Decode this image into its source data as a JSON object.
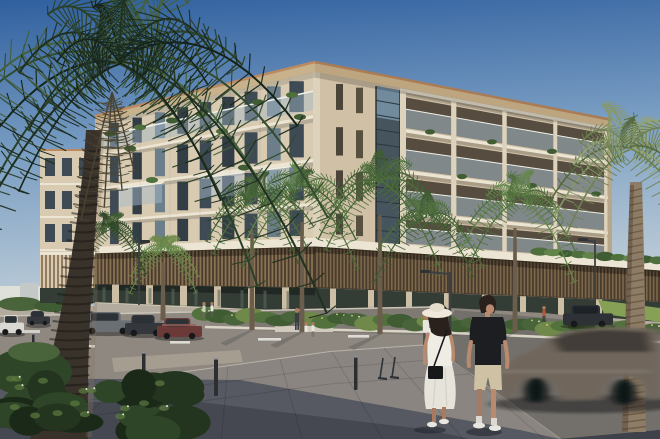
{
  "scene": {
    "type": "architectural-rendering",
    "description": "Sunny street-level view of a modern five-storey beige apartment building with wrap-around balconies, a timber-louvre podium and glazed ground floor, fronted by rows of palm trees; a couple crosses a paved plaza in the foreground while a motion-blurred car passes on the right.",
    "objects": [
      "sky",
      "apartment-building",
      "roof-cornice",
      "balconies",
      "louvre-podium",
      "storefront-glazing",
      "street-palm-trees",
      "left-palm-tree",
      "right-palm-tree",
      "road",
      "lane-markings",
      "far-sidewalk",
      "landscaping-strip",
      "foreground-plaza",
      "parked-cars",
      "moving-car",
      "pedestrian-couple",
      "background-pedestrians",
      "street-lamps",
      "bollards",
      "scooters",
      "foreground-shrubs",
      "distant-buildings"
    ]
  },
  "colors": {
    "sky_top": "#30609f",
    "sky_mid": "#7a9ec3",
    "sky_horizon": "#cdd7dc",
    "facade_front": "#d8cbb2",
    "facade_side": "#cfc0a6",
    "facade_top": "#e3d9c5",
    "facade_pier": "#ddd2bb",
    "fascia": "#ece5d3",
    "end_wall": "#b6a68a",
    "soffit_front": "#c8b28c",
    "soffit_side": "#bda57f",
    "copper": "#bc8a60",
    "copper_dark": "#a97c55",
    "window": "#3e4a54",
    "window_deep": "#333d46",
    "window_light": "#6c7e8a",
    "recess": "#564c40",
    "rail_glass": "#a5bac7",
    "rail_white": "#eef0ea",
    "corner_glass": "#46545e",
    "glass_sky": "#7c97ab",
    "mullion": "#2c363e",
    "slit": "#4a4439",
    "louver_dark": "#4a3c2c",
    "louver_fin": "#8a7254",
    "louver_fin2": "#7d684c",
    "storefront": "#333d36",
    "store_reflect": "#5a685c",
    "store_pier": "#cdbfa5",
    "sidewalk": "#b3ac9e",
    "road": "#8e8881",
    "marking": "#e8e6e0",
    "curb": "#cac4b8",
    "curb_near": "#b9b4aa",
    "plaza": "#8a8580",
    "plaza_mid": "#565961",
    "plaza_dark": "#454851",
    "plaza_corner": "#3f424a",
    "tactile": "#a59e90",
    "planting_dark": "#3f5c33",
    "planting": "#52713d",
    "planting_light": "#70894a",
    "hedge": "#49633a",
    "grass": "#86a055",
    "flower_y": "#c9cf7a",
    "flower_w": "#e4e6da",
    "planter_wall": "#cfcabb",
    "shrub1": "#24351f",
    "shrub2": "#2e4527",
    "shrub3": "#1b2a18",
    "shrub_hi": "#5d7a42",
    "palmL1": "#1f3020",
    "palmL2": "#2b4028",
    "palmL3": "#324a2e",
    "palmL4": "#16241a",
    "palmL5": "#44603a",
    "palm_dead": "#4a4332",
    "palmM1": "#4f6f3d",
    "palmM2": "#63854a",
    "palmM3": "#3f5c33",
    "palmR1": "#6e8152",
    "palmR2": "#87986a",
    "palmR3": "#55683f",
    "palmR4": "#93a376",
    "trunkL": "#39322a",
    "trunkR": "#8d7c66",
    "trunk_tex": "#171310",
    "trunkR_tex": "#5a4430",
    "car_gray": "#6a6f74",
    "car_dark": "#34383d",
    "car_white": "#d9d8d2",
    "car_maroon": "#6b3a38",
    "maroon_hi": "#96605a",
    "car_suv": "#2e3236",
    "car_glass": "#2c3136",
    "wheel": "#17181a",
    "moving_body": "#6f665b",
    "moving_win": "#3e3a33",
    "lamp": "#3c4043",
    "bollard": "#2c2e31",
    "scooter": "#2f3338",
    "skin": "#b98a6e",
    "skin_shade": "#a87b5e",
    "hair": "#2a211d",
    "white_cloth": "#efece4",
    "skirt": "#e6e3da",
    "hat": "#eee9db",
    "hat_crown": "#e4ddc9",
    "bag": "#17181a",
    "tee": "#1d1e22",
    "shorts": "#cfc2a4",
    "shoe": "#e8e6e0",
    "person_white": "#e8e6de",
    "person_dark": "#3a3e44",
    "person_orange": "#b05a35",
    "pants_dark": "#4a4e55",
    "shadow": "#1c2028",
    "distant_wall": "#dfe0da",
    "distant_wall2": "#c4c8c6"
  }
}
